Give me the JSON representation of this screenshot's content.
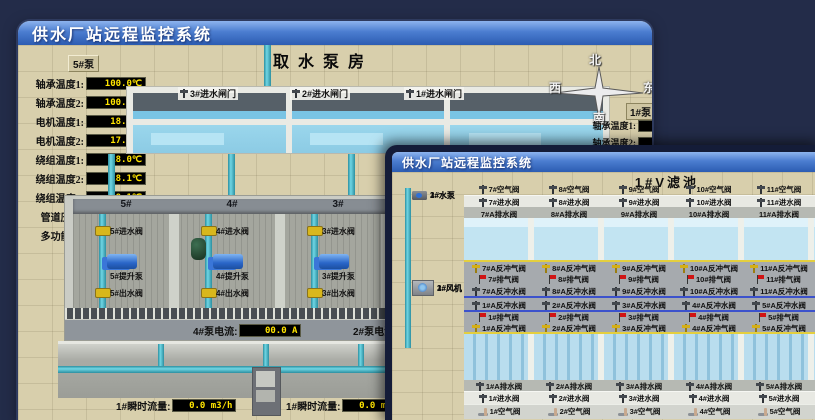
{
  "colors": {
    "page_bg": "#232c49",
    "titlebar_top": "#8db4ee",
    "titlebar_bottom": "#2c5cb2",
    "ground": "#d8cfac",
    "led_text": "#ffe400",
    "led_bg": "#000000",
    "water": "#8ccbe4",
    "pipe_teal": "#4fc2d4",
    "alarm_red": "#d01414",
    "valve_yellow": "#d8b71c"
  },
  "back_window": {
    "title": "供水厂站远程监控系统",
    "scene_title": "取水泵房",
    "pump_panel": {
      "header": "5#泵",
      "rows": [
        {
          "label": "轴承温度1:",
          "value": "100.0℃"
        },
        {
          "label": "轴承温度2:",
          "value": "100.0℃"
        },
        {
          "label": "电机温度1:",
          "value": "18.1℃"
        },
        {
          "label": "电机温度2:",
          "value": "17.9℃"
        },
        {
          "label": "绕组温度1:",
          "value": "18.0℃"
        },
        {
          "label": "绕组温度2:",
          "value": "18.1℃"
        },
        {
          "label": "绕组温度3:",
          "value": "18.1℃"
        },
        {
          "label": "管道压力:",
          "value": "0.0007MPa"
        },
        {
          "label": "多功能阀:",
          "value": "0%"
        }
      ]
    },
    "intake_gates": [
      "3#进水闸门",
      "2#进水闸门",
      "1#进水闸门"
    ],
    "compass": {
      "north": "北",
      "west": "西",
      "south": "南",
      "east": "东"
    },
    "right_panel": {
      "header": "1#泵",
      "rows": [
        {
          "label": "轴承温度1:"
        },
        {
          "label": "轴承温度2:"
        }
      ]
    },
    "pump_bays": [
      {
        "header": "5#",
        "inlet": "5#进水阀",
        "pump": "5#提升泵",
        "outlet": "5#出水阀"
      },
      {
        "header": "4#",
        "inlet": "4#进水阀",
        "pump": "4#提升泵",
        "outlet": "4#出水阀"
      },
      {
        "header": "3#",
        "inlet": "3#进水阀",
        "pump": "3#提升泵",
        "outlet": "3#出水阀"
      },
      {
        "header": "2#",
        "inlet": "2#进水阀",
        "pump": "2#提升泵",
        "outlet": "2#出水阀"
      }
    ],
    "current_displays": [
      {
        "label": "4#泵电流:",
        "value": "00.0 A"
      },
      {
        "label": "2#泵电流:",
        "value": ""
      }
    ],
    "flow_displays": [
      {
        "label": "1#瞬时流量:",
        "value": "0.0 m3/h"
      },
      {
        "label": "1#瞬时流量:",
        "value": "0.0 m3/h"
      }
    ]
  },
  "front_window": {
    "title": "供水厂站远程监控系统",
    "scene_title": "1#V滤池",
    "equipment": {
      "pumps": [
        "1#水泵",
        "2#水泵",
        "3#水泵"
      ],
      "blowers": [
        "1#风机",
        "2#风机",
        "3#风机"
      ]
    },
    "top_air_valves": [
      "7#空气阀",
      "8#空气阀",
      "9#空气阀",
      "10#空气阀",
      "11#空气阀",
      "12#空气阀"
    ],
    "top_inlet_valves": [
      "7#进水阀",
      "8#进水阀",
      "9#进水阀",
      "10#进水阀",
      "11#进水阀",
      "12#进水阀"
    ],
    "top_drain_valves": [
      "7#A排水阀",
      "8#A排水阀",
      "9#A排水阀",
      "10#A排水阀",
      "11#A排水阀",
      "12#A排水阀"
    ],
    "top_backwash_air_valves": [
      "7#A反冲气阀",
      "8#A反冲气阀",
      "9#A反冲气阀",
      "10#A反冲气阀",
      "11#A反冲气阀",
      "12#A反冲气阀"
    ],
    "top_exhaust_valves": [
      "7#排气阀",
      "8#排气阀",
      "9#排气阀",
      "10#排气阀",
      "11#排气阀",
      "12#排气阀"
    ],
    "top_backwash_water_valves": [
      "7#A反冲水阀",
      "8#A反冲水阀",
      "9#A反冲水阀",
      "10#A反冲水阀",
      "11#A反冲水阀",
      "12#A反冲水阀"
    ],
    "bottom_backwash_water_valves": [
      "1#A反冲水阀",
      "2#A反冲水阀",
      "3#A反冲水阀",
      "4#A反冲水阀",
      "5#A反冲水阀",
      "6#A反冲水阀"
    ],
    "bottom_exhaust_valves": [
      "1#排气阀",
      "2#排气阀",
      "3#排气阀",
      "4#排气阀",
      "5#排气阀",
      "6#排气阀"
    ],
    "bottom_backwash_air_valves": [
      "1#A反冲气阀",
      "2#A反冲气阀",
      "3#A反冲气阀",
      "4#A反冲气阀",
      "5#A反冲气阀",
      "6#A反冲气阀"
    ],
    "bottom_drain_valves": [
      "1#A排水阀",
      "2#A排水阀",
      "3#A排水阀",
      "4#A排水阀",
      "5#A排水阀",
      "6#A排水阀"
    ],
    "bottom_inlet_valves": [
      "1#进水阀",
      "2#进水阀",
      "3#进水阀",
      "4#进水阀",
      "5#进水阀",
      "6#进水阀"
    ],
    "bottom_air_valves": [
      "1#空气阀",
      "2#空气阀",
      "3#空气阀",
      "4#空气阀",
      "5#空气阀",
      "6#空气阀"
    ]
  }
}
